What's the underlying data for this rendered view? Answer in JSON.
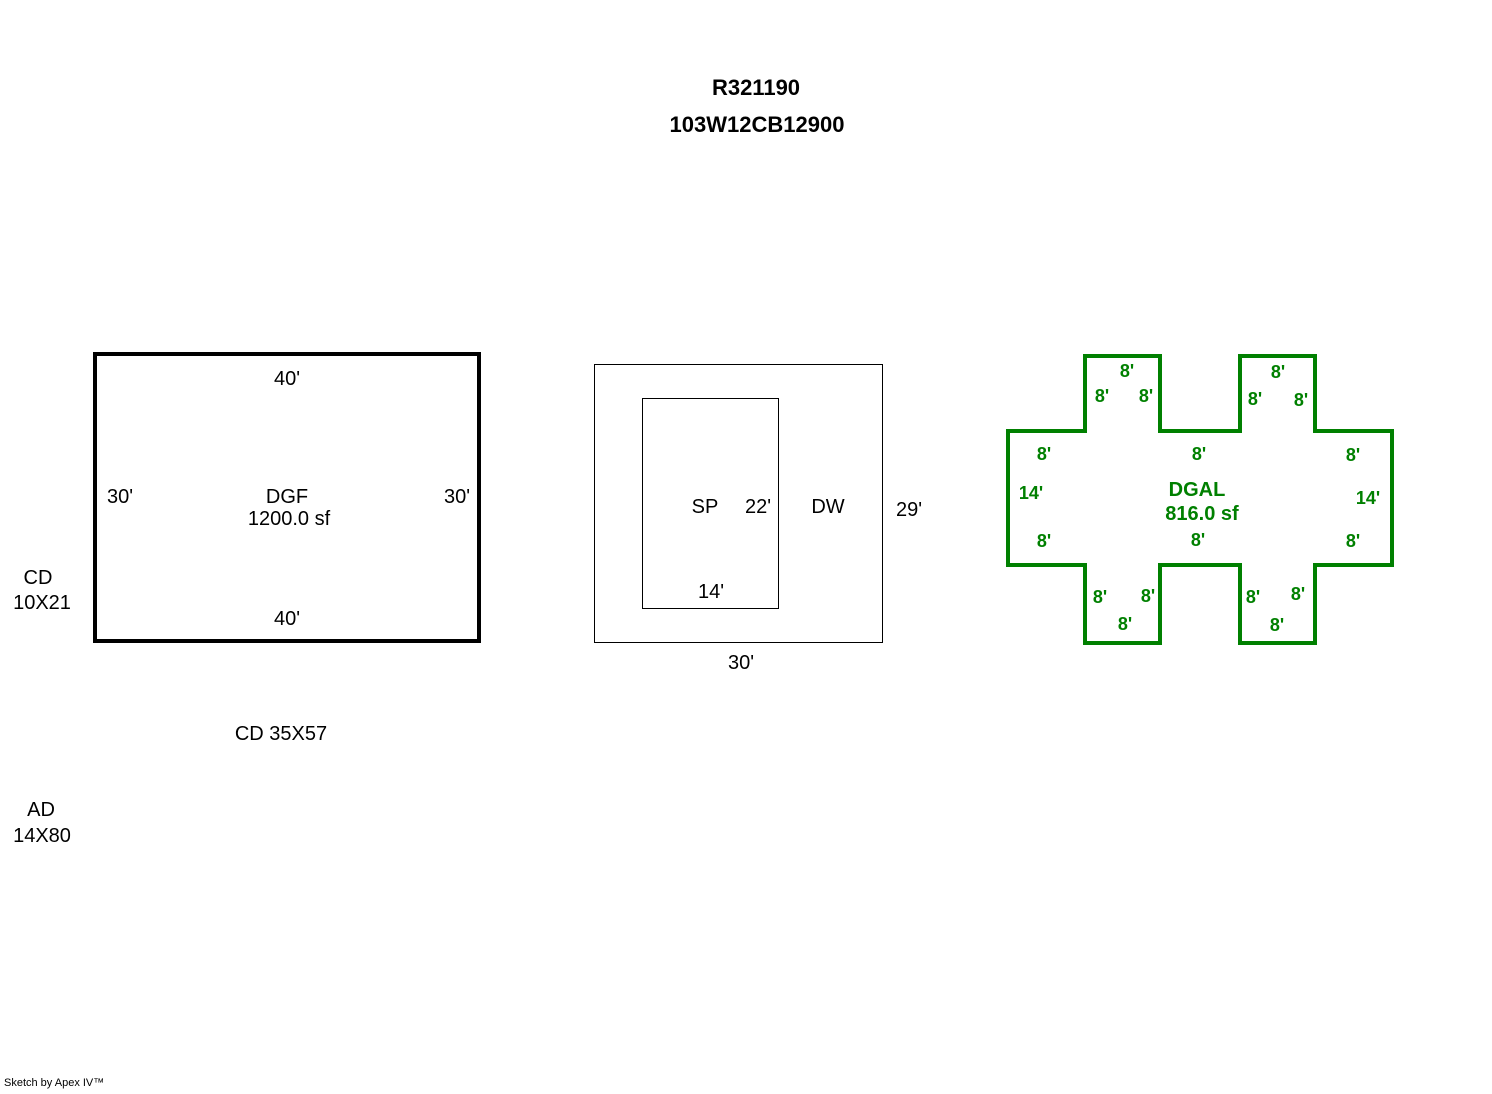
{
  "header": {
    "title1": "R321190",
    "title2": "103W12CB12900"
  },
  "colors": {
    "outline_black": "#000000",
    "outline_green": "#008000"
  },
  "dgf": {
    "name": "DGF",
    "area": "1200.0 sf",
    "dim_top": "40'",
    "dim_bottom": "40'",
    "dim_left": "30'",
    "dim_right": "30'"
  },
  "side_notes": {
    "cd_small_line1": "CD",
    "cd_small_line2": "10X21",
    "cd_large": "CD 35X57",
    "ad_line1": "AD",
    "ad_line2": "14X80"
  },
  "dw": {
    "name": "DW",
    "dim_right": "29'",
    "dim_bottom": "30'",
    "sp": {
      "name": "SP",
      "dim_right": "22'",
      "dim_bottom": "14'"
    }
  },
  "dgal": {
    "name": "DGAL",
    "area": "816.0 sf",
    "dims": {
      "side_left": "14'",
      "side_right": "14'",
      "top_edge": {
        "left": "8'",
        "center": "8'",
        "right": "8'"
      },
      "bottom_edge": {
        "left": "8'",
        "center": "8'",
        "right": "8'"
      },
      "tower_top_left": {
        "top": "8'",
        "left": "8'",
        "right": "8'"
      },
      "tower_top_right": {
        "top": "8'",
        "left": "8'",
        "right": "8'"
      },
      "tower_bottom_left": {
        "bottom": "8'",
        "left": "8'",
        "right": "8'"
      },
      "tower_bottom_right": {
        "bottom": "8'",
        "left": "8'",
        "right": "8'"
      }
    }
  },
  "footer": {
    "credit": "Sketch by Apex IV™"
  }
}
